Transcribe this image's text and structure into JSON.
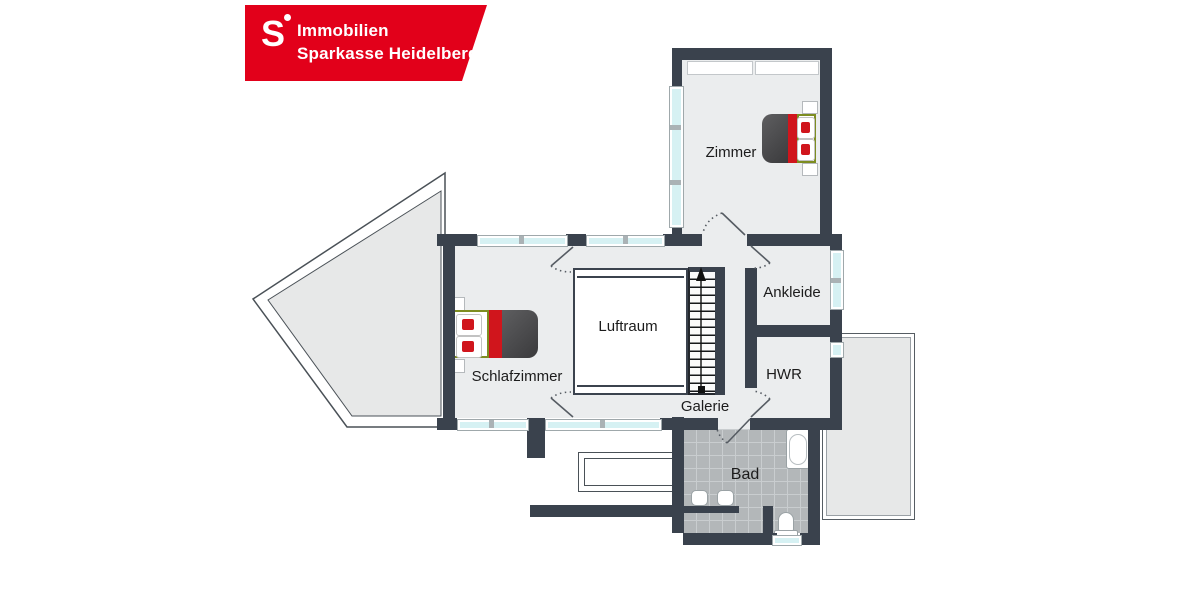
{
  "brand": {
    "icon_letter": "S",
    "line1": "Immobilien",
    "line2": "Sparkasse Heidelberg",
    "brand_red": "#e2001a",
    "text_color": "#ffffff"
  },
  "rooms": {
    "zimmer": "Zimmer",
    "ankleide": "Ankleide",
    "hwr": "HWR",
    "schlafzimmer": "Schlafzimmer",
    "luftraum": "Luftraum",
    "galerie": "Galerie",
    "bad": "Bad"
  },
  "palette": {
    "wall": "#3a424d",
    "floor": "#ebedee",
    "window_glass": "#d6f1f3",
    "terrace_gray": "#e7e8e8",
    "bath_tile": "#b3b7b9",
    "bed_red": "#d0151c",
    "bed_blanket": "#46464a",
    "bed_frame_green": "#7d8d21",
    "background": "#ffffff"
  },
  "symbols": {
    "stairs_direction": "up",
    "fixtures": [
      "bathtub",
      "sink",
      "sink",
      "toilet"
    ],
    "furniture": [
      "double-bed",
      "double-bed",
      "closet",
      "closet"
    ]
  }
}
